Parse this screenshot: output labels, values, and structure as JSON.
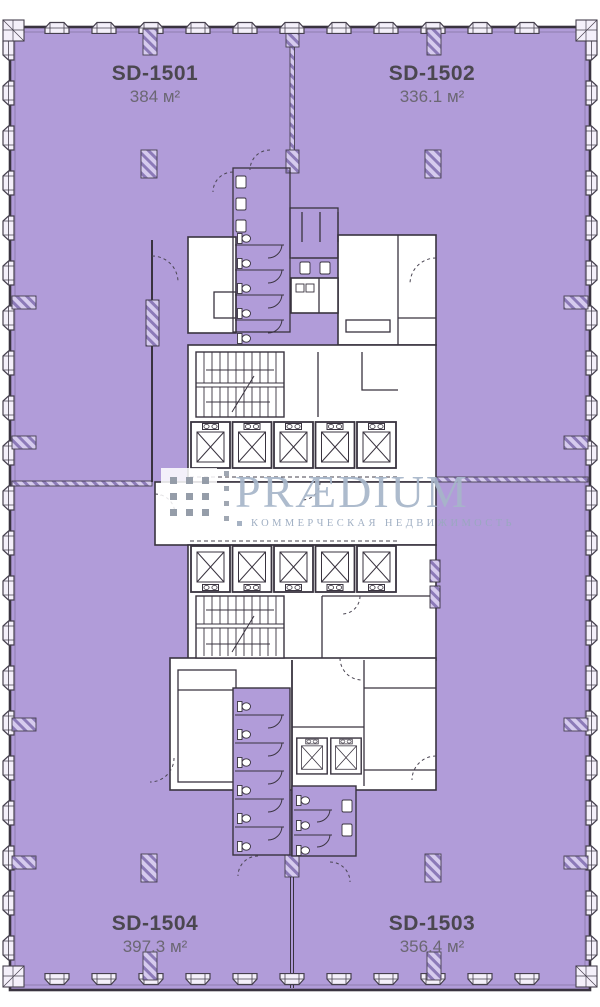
{
  "units": [
    {
      "id": "SD-1501",
      "area": "384 м²"
    },
    {
      "id": "SD-1502",
      "area": "336.1 м²"
    },
    {
      "id": "SD-1503",
      "area": "356.4 м²"
    },
    {
      "id": "SD-1504",
      "area": "397.3 м²"
    }
  ],
  "watermark": {
    "brand": "PRÆDIUM",
    "tagline": "КОММЕРЧЕСКАЯ НЕДВИЖИМОСТЬ"
  },
  "colors": {
    "floor_fill": "#b19cd9",
    "wall_line": "#39333f",
    "unit_id_text": "#4b4750",
    "unit_area_text": "#6b6773",
    "watermark_text": "#a6b5c9"
  }
}
